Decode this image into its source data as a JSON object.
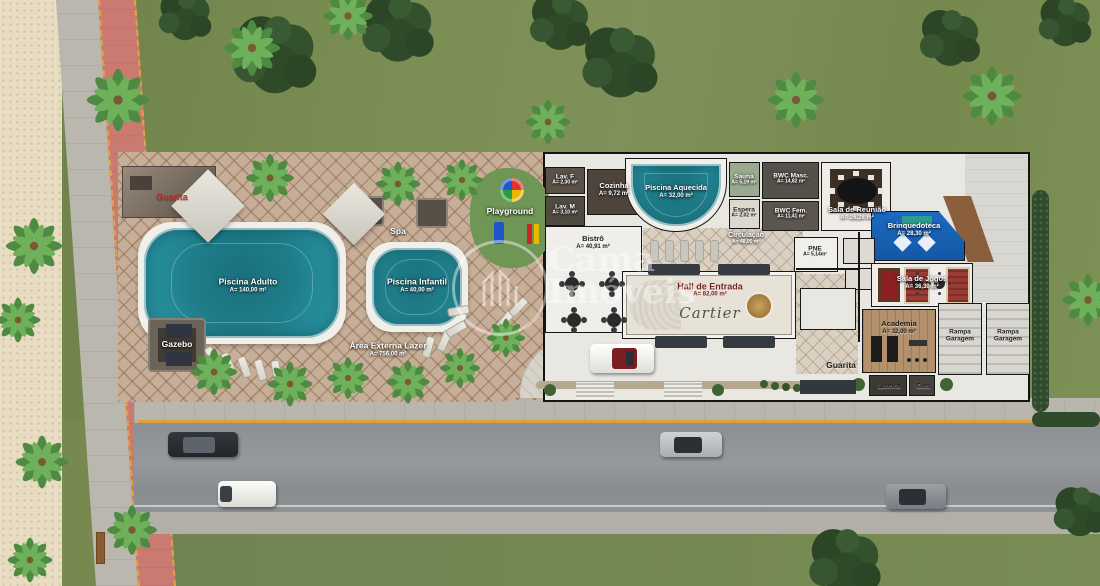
{
  "watermark": {
    "line1": "Cama",
    "line2": "Imóveis"
  },
  "outdoor": {
    "guarita_top": "Guarita",
    "spa": "Spa",
    "playground": "Playground",
    "gazebo": "Gazebo",
    "piscina_adulto": {
      "name": "Piscina Adulto",
      "area": "A= 140,00 m²"
    },
    "piscina_infantil": {
      "name": "Piscina Infantil",
      "area": "A= 40,00 m²"
    },
    "area_externa": {
      "name": "Área Externa Lazer",
      "area": "A= 756,00 m²"
    }
  },
  "rooms": {
    "lav_f": {
      "name": "Lav. F",
      "area": "A= 2,30 m²"
    },
    "lav_m": {
      "name": "Lav. M",
      "area": "A= 3,10 m²"
    },
    "cozinha": {
      "name": "Cozinha",
      "area": "A= 9,72 m²"
    },
    "bistro": {
      "name": "Bistrô",
      "area": "A= 40,91 m²"
    },
    "piscina_aquecida": {
      "name": "Piscina Aquecida",
      "area": "A= 32,00 m²"
    },
    "sauna": {
      "name": "Sauna",
      "area": "A= 5,19 m²"
    },
    "espera": {
      "name": "Espera",
      "area": "A= 2,02 m²"
    },
    "bwc_masc": {
      "name": "BWC Masc.",
      "area": "A= 14,82 m²"
    },
    "bwc_fem": {
      "name": "BWC Fem.",
      "area": "A= 11,41 m²"
    },
    "sala_reuniao": {
      "name": "Sala de Reunião",
      "area": "A= 26,28 m²"
    },
    "circulacao": {
      "name": "Circulação",
      "area": "A= 48,00 m²"
    },
    "brinquedoteca": {
      "name": "Brinquedoteca",
      "area": "A= 28,30 m²"
    },
    "pne": {
      "name": "PNE",
      "area": "A= 5,14m²"
    },
    "hall_entrada": {
      "name": "Hall de Entrada",
      "area": "A= 82,00 m²",
      "inlay": "Cartier"
    },
    "sala_jogos": {
      "name": "Sala de Jogos",
      "area": "A= 36,30 m²"
    },
    "academia": {
      "name": "Academia",
      "area": "A= 32,00 m²"
    },
    "rampa": {
      "line1": "Rampa",
      "line2": "Garagem"
    },
    "lixeira": "Lixeira",
    "gas": "Gás",
    "guarita_bottom": "Guarita"
  },
  "colors": {
    "pool_water": "#1f7d8a",
    "bike_path": "#ca7a70",
    "brinquedoteca_blue": "#1b67c1",
    "guarita_label_red": "#bf2b24"
  }
}
